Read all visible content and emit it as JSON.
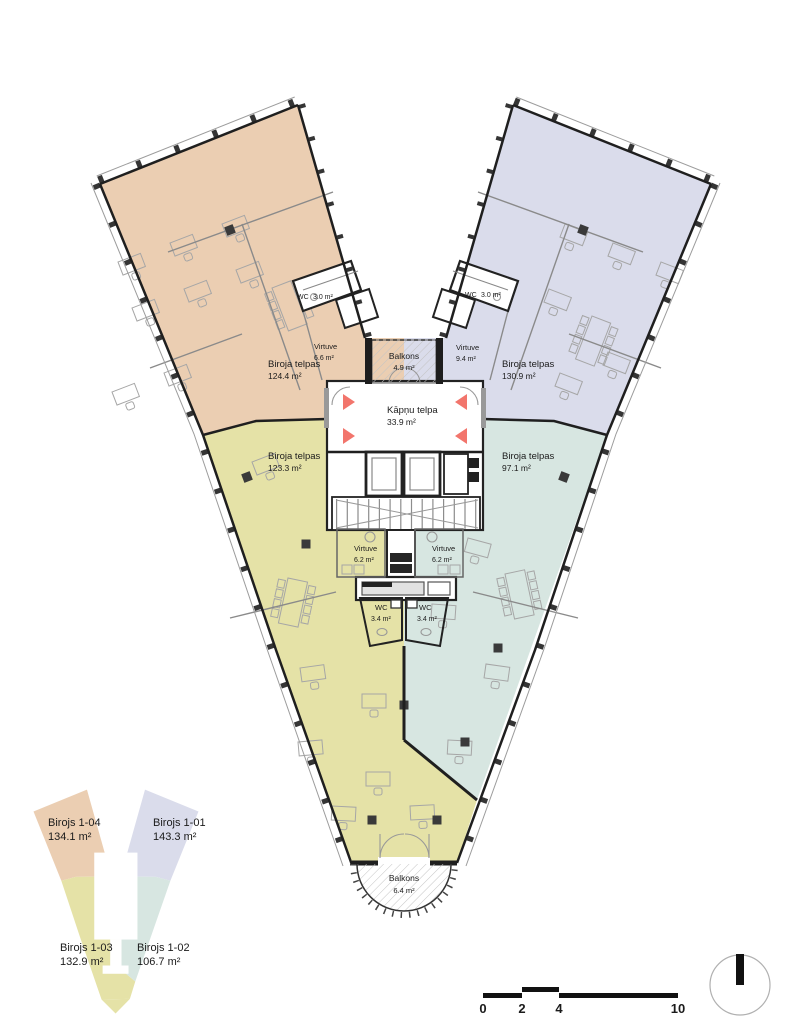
{
  "colors": {
    "office_1_04": "#ebceb2",
    "office_1_01": "#dadceb",
    "office_1_03": "#e5e2a7",
    "office_1_02": "#d7e6e1",
    "exit_marker": "#f2756c"
  },
  "plan": {
    "offices": [
      {
        "name": "Biroja telpas",
        "area": "124.4 m²"
      },
      {
        "name": "Biroja telpas",
        "area": "130.9 m²"
      },
      {
        "name": "Biroja telpas",
        "area": "123.3 m²"
      },
      {
        "name": "Biroja telpas",
        "area": "97.1 m²"
      }
    ],
    "kitchens": [
      {
        "name": "Virtuve",
        "area": "6.6 m²"
      },
      {
        "name": "Virtuve",
        "area": "9.4 m²"
      },
      {
        "name": "Virtuve",
        "area": "6.2 m²"
      },
      {
        "name": "Virtuve",
        "area": "6.2 m²"
      }
    ],
    "wcs": [
      {
        "name": "WC",
        "area": "3.0 m²"
      },
      {
        "name": "WC",
        "area": "3.0 m²"
      },
      {
        "name": "WC",
        "area": "3.4 m²"
      },
      {
        "name": "WC",
        "area": "3.4 m²"
      }
    ],
    "stairwell": {
      "name": "Kāpņu telpa",
      "area": "33.9 m²"
    },
    "balconies": [
      {
        "name": "Balkons",
        "area": "4.9 m²"
      },
      {
        "name": "Balkons",
        "area": "6.4 m²"
      }
    ]
  },
  "legend": {
    "items": [
      {
        "name": "Birojs 1-04",
        "area": "134.1 m²"
      },
      {
        "name": "Birojs 1-01",
        "area": "143.3 m²"
      },
      {
        "name": "Birojs 1-03",
        "area": "132.9 m²"
      },
      {
        "name": "Birojs 1-02",
        "area": "106.7 m²"
      }
    ]
  },
  "scale_bar": {
    "ticks": [
      "0",
      "2",
      "4",
      "10"
    ]
  }
}
